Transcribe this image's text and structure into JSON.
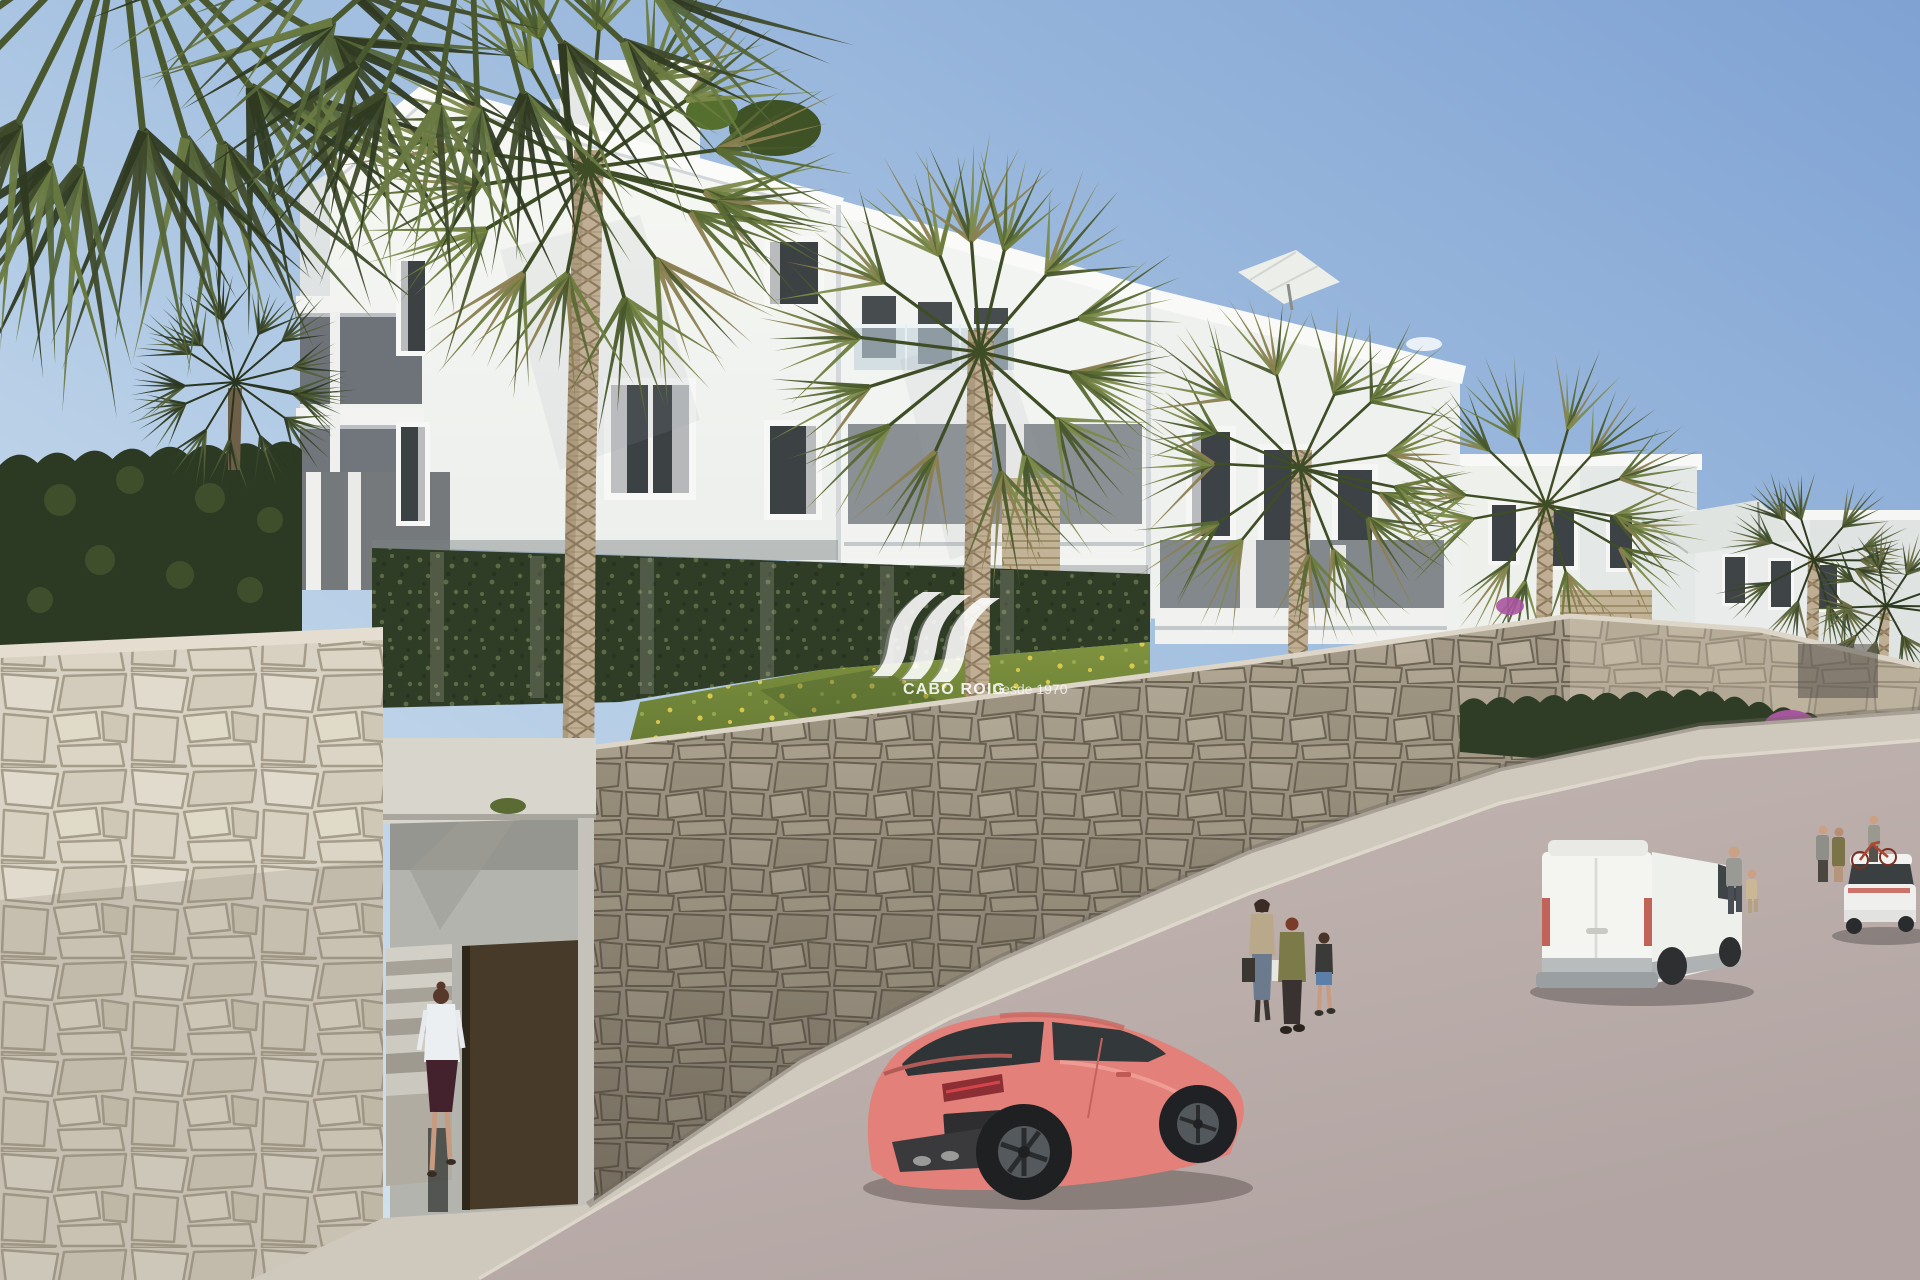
{
  "watermark": {
    "brand": "CABO ROIG",
    "tagline": "Desde 1970",
    "logo_icon": "cabo-roig-wave-logo",
    "color": "#ffffff"
  },
  "scene": {
    "description": "Architectural render: white hillside apartment complex with palm trees, rubble-stone retaining walls, a street entrance, pedestrians, a coral sports coupe, a white panel van and a white sedan on a sloping street",
    "objects": [
      "sky",
      "clouds",
      "apartment-building-left-wing",
      "apartment-building-mid-wing",
      "apartment-building-right-wing",
      "far-right-buildings",
      "penthouse",
      "roof-umbrella",
      "shade-sail",
      "rooftop-plants",
      "windows",
      "balcony-doors",
      "glass-balustrade",
      "hedge-left",
      "ivy-wall",
      "grass-slope",
      "palm-trees",
      "foreground-stone-wall",
      "street-stone-wall",
      "entrance-alcove",
      "entrance-stairs",
      "entrance-door",
      "entrance-plaque",
      "bougainvillea",
      "sidewalk",
      "road",
      "coral-sports-car",
      "white-van",
      "white-sedan",
      "woman-at-entrance",
      "pedestrian-group",
      "man-with-child",
      "people-at-far-entrance",
      "bicycle",
      "watermark"
    ],
    "palette": {
      "sky_top": "#7fa2d3",
      "sky_horizon": "#cfe0ee",
      "building_white": "#f5f6f2",
      "building_shade": "#e7eaea",
      "recess_grey": "#8b9095",
      "glass_dark": "#3c4245",
      "stone_foreground": "#dcd6c9",
      "stone_street": "#aba18f",
      "stone_right": "#cfc3ae",
      "ivy_green": "#33402a",
      "hedge_green": "#2f3d26",
      "grass_green": "#6d8039",
      "flower_yellow": "#e3cf4e",
      "palm_green": "#5a6a34",
      "trunk_tan": "#bfae93",
      "road_asphalt": "#b7aaa7",
      "sidewalk_grey": "#cfc8bd",
      "car_coral": "#e28079",
      "car_glass": "#2f3437",
      "van_white": "#f2f2ef",
      "door_brown": "#473a28",
      "bougainvillea_purple": "#a855a0"
    }
  }
}
